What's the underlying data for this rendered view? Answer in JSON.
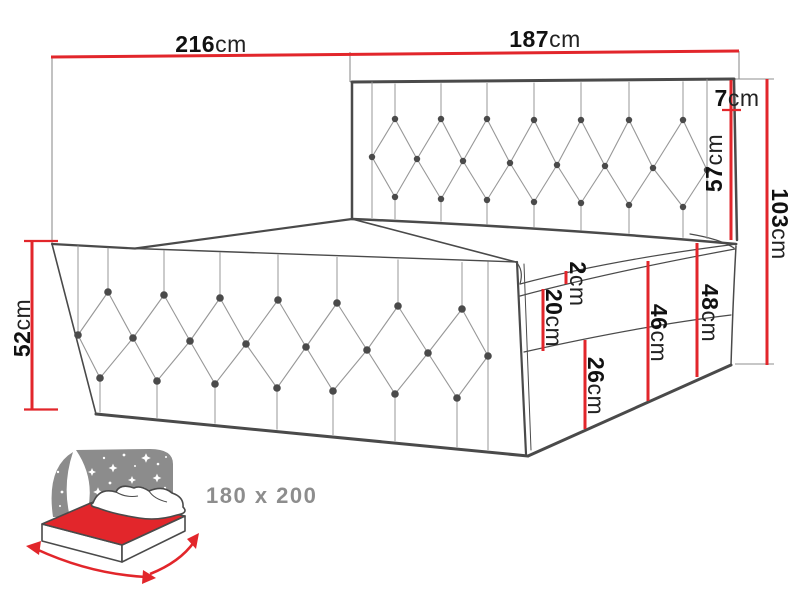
{
  "diagram_title": "bed-dimensions-diagram",
  "dimensions": {
    "length_total": {
      "num": "216",
      "unit": "cm"
    },
    "headboard_width": {
      "num": "187",
      "unit": "cm"
    },
    "top_rail": {
      "num": "7",
      "unit": "cm"
    },
    "headboard_above_mattress": {
      "num": "57",
      "unit": "cm"
    },
    "total_height": {
      "num": "103",
      "unit": "cm"
    },
    "topper_thickness": {
      "num": "2",
      "unit": "cm"
    },
    "mattress_thickness": {
      "num": "20",
      "unit": "cm"
    },
    "base_box_height": {
      "num": "26",
      "unit": "cm"
    },
    "base_mid_height": {
      "num": "46",
      "unit": "cm"
    },
    "base_right_height": {
      "num": "48",
      "unit": "cm"
    },
    "side_panel_height": {
      "num": "52",
      "unit": "cm"
    }
  },
  "size_label": "180 x 200",
  "colors": {
    "dimension_red": "#e2262b",
    "outline": "#4a4a4a",
    "tuft_line": "#979797",
    "icon_gray": "#8c8c8c",
    "label_text": "#111111",
    "label_gray": "#8d8d8d"
  }
}
